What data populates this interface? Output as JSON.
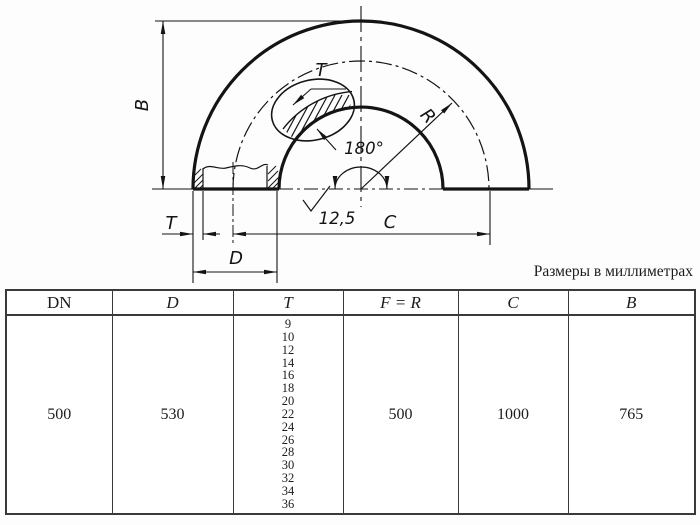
{
  "note": "Размеры в миллиметрах",
  "drawing": {
    "dim_b": "B",
    "dim_t_section": "T",
    "dim_t": "T",
    "dim_d": "D",
    "dim_c": "C",
    "dim_r": "R",
    "angle": "180°",
    "roughness": "12,5"
  },
  "table": {
    "headers": [
      "DN",
      "D",
      "T",
      "F = R",
      "C",
      "B"
    ],
    "row": {
      "dn": "500",
      "d": "530",
      "t_values": [
        "9",
        "10",
        "12",
        "14",
        "16",
        "18",
        "20",
        "22",
        "24",
        "26",
        "28",
        "30",
        "32",
        "34",
        "36"
      ],
      "f_r": "500",
      "c": "1000",
      "b": "765"
    }
  }
}
